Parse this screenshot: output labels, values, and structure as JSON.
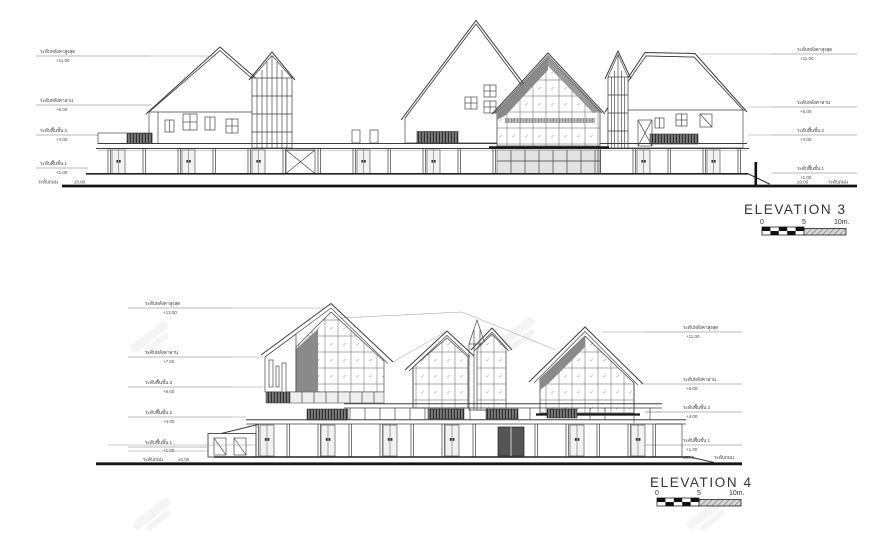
{
  "page": {
    "background": "#ffffff",
    "line_color": "#3b3b3b",
    "louver_color": "#6b6b6b",
    "glass_shade_color": "#8a8a8a"
  },
  "elevation3": {
    "title": "ELEVATION 3",
    "scale_bar": {
      "start_label": "0",
      "mid_label": "5",
      "end_label": "10m."
    },
    "levels_left": [
      {
        "name": "ระดับหลังคาสูงสุด",
        "value": "+11.00"
      },
      {
        "name": "ระดับหลังคาลาน",
        "value": "+6.00"
      },
      {
        "name": "ระดับพื้นชั้น 2",
        "value": "+4.00"
      },
      {
        "name": "ระดับพื้นชั้น 1",
        "value": "+1.00"
      },
      {
        "name": "ระดับถนน",
        "value": "±0.00"
      }
    ],
    "levels_right": [
      {
        "name": "ระดับหลังคาสูงสุด",
        "value": "+11.00"
      },
      {
        "name": "ระดับหลังคาลาน",
        "value": "+6.00"
      },
      {
        "name": "ระดับพื้นชั้น 2",
        "value": "+4.00"
      },
      {
        "name": "ระดับพื้นชั้น 1",
        "value": "+1.00"
      },
      {
        "name": "ระดับถนน",
        "value": "±0.00"
      }
    ]
  },
  "elevation4": {
    "title": "ELEVATION 4",
    "scale_bar": {
      "start_label": "0",
      "mid_label": "5",
      "end_label": "10m."
    },
    "levels_left": [
      {
        "name": "ระดับหลังคาสูงสุด",
        "value": "+13.00"
      },
      {
        "name": "ระดับหลังคาลาน",
        "value": "+7.50"
      },
      {
        "name": "ระดับพื้นชั้น 3",
        "value": "+6.00"
      },
      {
        "name": "ระดับพื้นชั้น 2",
        "value": "+4.00"
      },
      {
        "name": "ระดับพื้นชั้น 1",
        "value": "+1.00"
      },
      {
        "name": "ระดับถนน",
        "value": "±0.00"
      }
    ],
    "levels_right": [
      {
        "name": "ระดับหลังคาสูงสุด",
        "value": "+11.00"
      },
      {
        "name": "ระดับหลังคาลาน",
        "value": "+6.00"
      },
      {
        "name": "ระดับพื้นชั้น 2",
        "value": "+4.00"
      },
      {
        "name": "ระดับพื้นชั้น 1",
        "value": "+1.00"
      },
      {
        "name": "ระดับถนน",
        "value": "±0.00"
      }
    ]
  }
}
